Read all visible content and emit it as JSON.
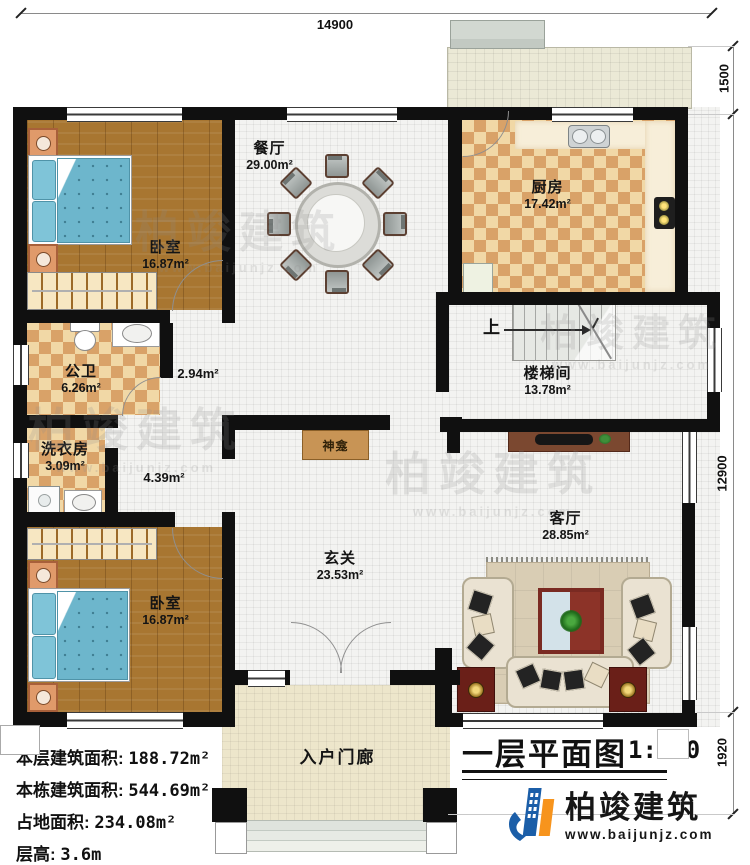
{
  "plan": {
    "title": "一层平面图",
    "scale": "1:100"
  },
  "dimensions": {
    "top": "14900",
    "right_upper": "1500",
    "right_middle": "12900",
    "right_lower": "1920"
  },
  "rooms": {
    "bedroom1": {
      "name": "卧室",
      "area": "16.87m²"
    },
    "dining": {
      "name": "餐厅",
      "area": "29.00m²"
    },
    "kitchen": {
      "name": "厨房",
      "area": "17.42m²"
    },
    "bathroom": {
      "name": "公卫",
      "area": "6.26m²"
    },
    "corridor1": {
      "area": "2.94m²"
    },
    "laundry": {
      "name": "洗衣房",
      "area": "3.09m²"
    },
    "corridor2": {
      "area": "4.39m²"
    },
    "stairwell": {
      "name": "楼梯间",
      "area": "13.78m²",
      "up": "上"
    },
    "foyer": {
      "name": "玄关",
      "area": "23.53m²"
    },
    "living": {
      "name": "客厅",
      "area": "28.85m²"
    },
    "bedroom2": {
      "name": "卧室",
      "area": "16.87m²"
    },
    "porch": {
      "name": "入户门廊"
    },
    "shrine": {
      "name": "神龛"
    }
  },
  "stats": [
    {
      "label": "本层建筑面积:",
      "value": "188.72m²"
    },
    {
      "label": "本栋建筑面积:",
      "value": "544.69m²"
    },
    {
      "label": "占地面积:",
      "value": "234.08m²"
    },
    {
      "label": "层高:",
      "value": "3.6m"
    }
  ],
  "branding": {
    "company": "柏竣建筑",
    "website": "www.baijunjz.com"
  },
  "watermark": {
    "company": "柏竣建筑",
    "website": "www.baijunjz.com"
  },
  "colors": {
    "wall": "#101010",
    "logo_blue": "#1b5ea8",
    "logo_orange": "#f7941d"
  }
}
